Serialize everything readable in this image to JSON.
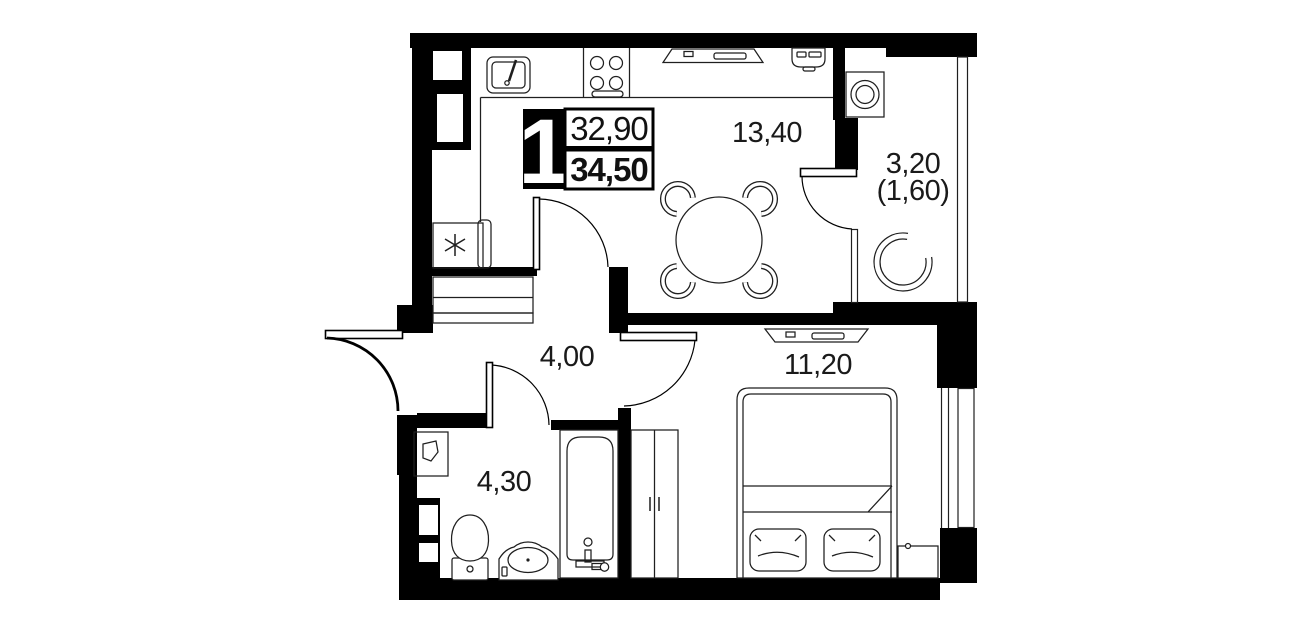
{
  "plan": {
    "type": "apartment-floor-plan",
    "badge": {
      "rooms_count": "1",
      "living_area": "32,90",
      "total_area": "34,50"
    },
    "labels": {
      "kitchen_living": "13,40",
      "balcony": "3,20",
      "balcony_secondary": "(1,60)",
      "hallway": "4,00",
      "bedroom": "11,20",
      "bathroom": "4,30"
    },
    "colors": {
      "wall": "#000000",
      "line": "#1f1f1f",
      "background": "#ffffff",
      "badge_bg": "#000000",
      "badge_text": "#ffffff"
    },
    "furniture_icons": [
      "kitchen-sink-icon",
      "stove-icon",
      "fridge-icon",
      "kitchen-counter-icon",
      "hallway-cabinet-icon",
      "wall-tv-icon",
      "ac-unit-icon",
      "dining-table-icon",
      "chair-icon",
      "washing-machine-icon",
      "round-armchair-icon",
      "bed-icon",
      "pillow-icon",
      "wardrobe-icon",
      "bedroom-tv-icon",
      "nightstand-icon",
      "mirror-box-icon",
      "toilet-icon",
      "washbasin-icon",
      "bathtub-icon"
    ]
  }
}
